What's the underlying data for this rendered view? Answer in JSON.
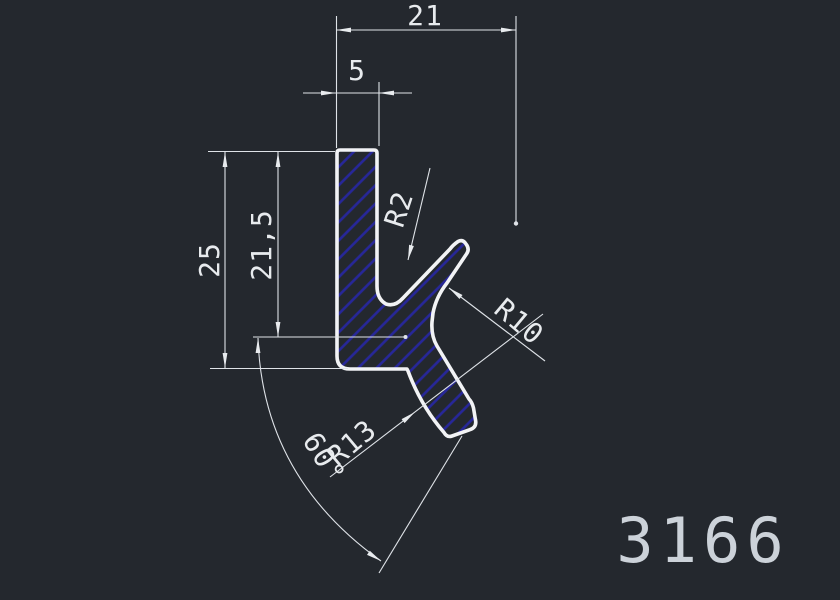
{
  "drawing": {
    "part_number": "3166",
    "dimensions": {
      "width_top": "21",
      "wall_thickness": "5",
      "height_total": "25",
      "height_inner": "21,5",
      "radius_small": "R2",
      "radius_mid": "R10",
      "radius_large": "R13",
      "angle": "60°"
    },
    "colors": {
      "background": "#24282e",
      "line": "#e8ebee",
      "hatch_blue": "#27279a",
      "part_number_color": "#ccd2d9"
    }
  }
}
